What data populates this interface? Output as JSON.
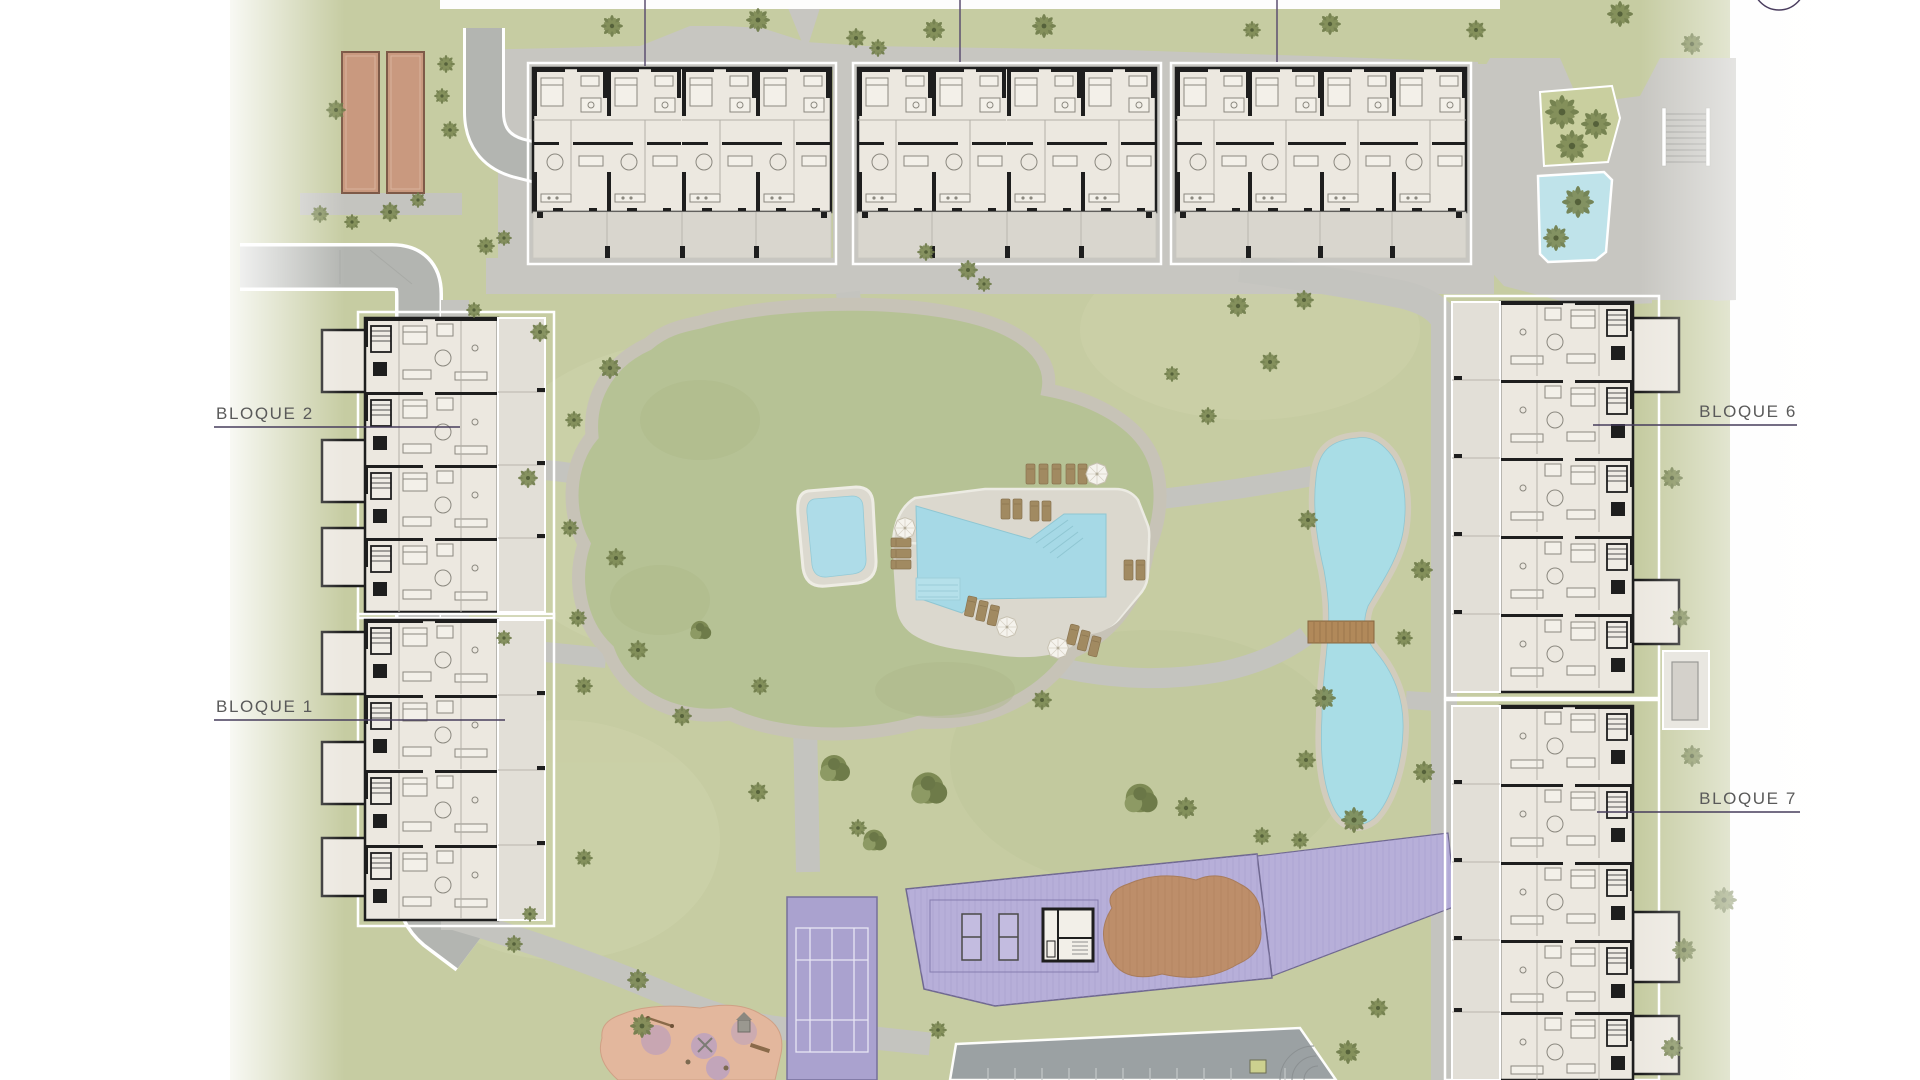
{
  "page": {
    "title": "Residential complex master site plan"
  },
  "labels": {
    "blocks": [
      {
        "id": "bloque-2",
        "text": "BLOQUE 2"
      },
      {
        "id": "bloque-1",
        "text": "BLOQUE 1"
      },
      {
        "id": "bloque-6",
        "text": "BLOQUE 6"
      },
      {
        "id": "bloque-7",
        "text": "BLOQUE 7"
      }
    ]
  },
  "icons": {
    "compass": "circle-outline-compass",
    "umbrella": "parasol-octagon",
    "tree": "palm-tuft",
    "stairs": "stair-treads",
    "bridge": "wooden-plank-bridge"
  },
  "colors": {
    "lawn": "#c6cca2",
    "mound_lawn": "#b6c295",
    "path_gray": "#c4c4bf",
    "road_gray": "#b3b5b1",
    "pavement": "#c7c6c1",
    "deck": "#dbd8ce",
    "pool_water": "#a6d9e6",
    "kids_pool_water": "#aedce8",
    "lake_water": "#a9dde6",
    "water_feature": "#bfe3ea",
    "building_floor": "#ece8e0",
    "building_wall": "#1e1e1e",
    "terrace": "#d9d6ce",
    "court_purple": "#aaa2cf",
    "deck_purple": "#b7afd9",
    "sand_brown": "#bd8e6a",
    "playground_pink": "#e3b79d",
    "petanque_brown": "#c9997f",
    "lounger_brown": "#a18a61",
    "bridge_brown": "#b1895a",
    "parking_asphalt": "#9ba1a3",
    "label_text": "#5a5a5a",
    "leader_line": "#473d5c"
  }
}
